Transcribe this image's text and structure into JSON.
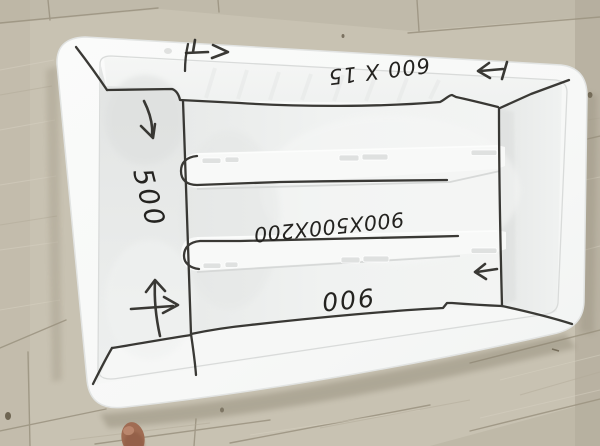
{
  "scene": {
    "description": "Top-down photo of a white plastic formwork mould box lying on a light wooden plank floor, annotated by hand in black marker with dimensions and arrows",
    "object": "white plastic mould box with two divider ribs",
    "surface": "light wood plank floor"
  },
  "annotations": {
    "top": "600 X 15",
    "left": "500",
    "center": "900X500X200",
    "bottom": "900"
  },
  "marks": {
    "top_left_arrow": "arrow-right",
    "top_right_arrow": "arrow-left-with-stop-bar",
    "left_wall_arrow": "curved-arrow-down-right",
    "cross_arrows": "crossed-arrows-up-and-right",
    "right_side_arrow": "arrow-left"
  },
  "colors": {
    "marker": "#2a2925",
    "mould_white": "#f7f8f7",
    "floor_wood": "#c8c2b2",
    "toe_skin": "#a06c53"
  }
}
